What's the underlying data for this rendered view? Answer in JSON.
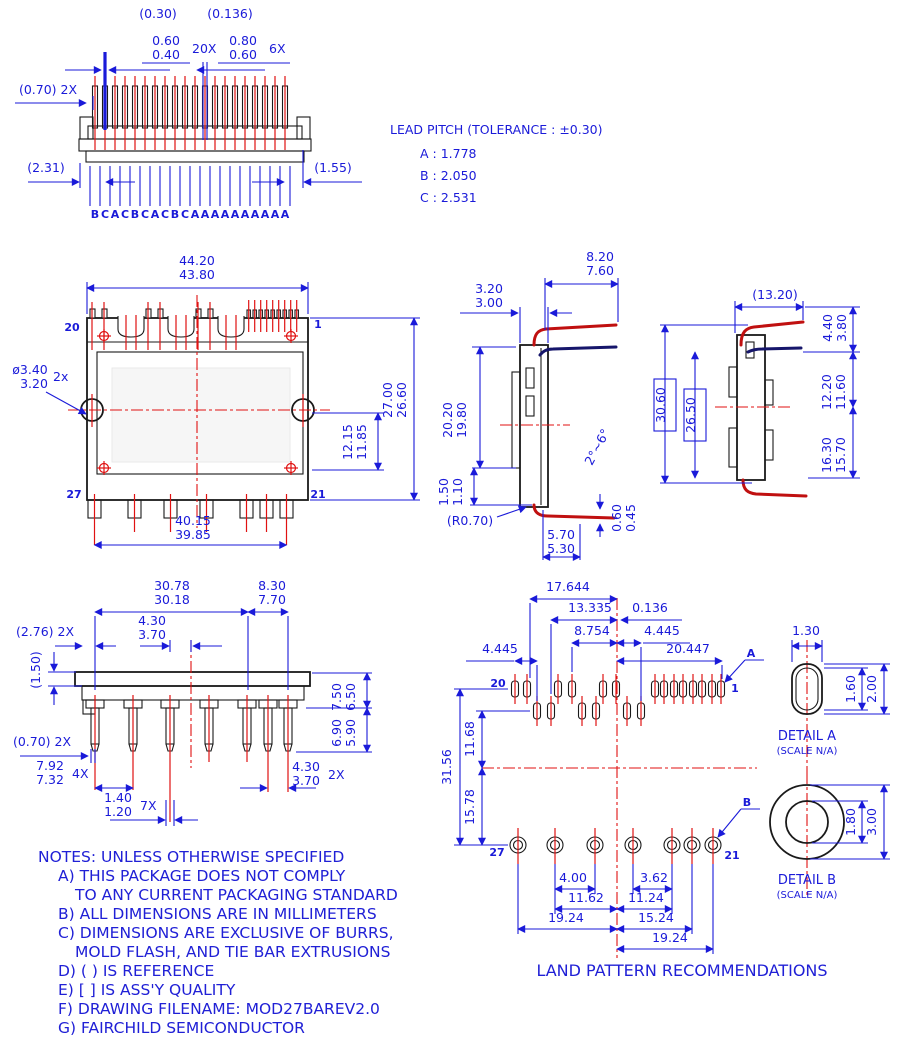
{
  "colors": {
    "dimension_blue": "#1a1ad9",
    "lead_red": "#c01010",
    "lead_dark_blue": "#16166b",
    "outline_black": "#1a1a1a",
    "background": "#ffffff"
  },
  "top_view": {
    "ref_030": "(0.30)",
    "ref_0136": "(0.136)",
    "w1_max": "0.60",
    "w1_min": "0.40",
    "w1_qty": "20X",
    "w2_max": "0.80",
    "w2_min": "0.60",
    "w2_qty": "6X",
    "ref_070": "(0.70) 2X",
    "ref_231": "(2.31)",
    "ref_155": "(1.55)",
    "letters": [
      "B",
      "C",
      "A",
      "C",
      "B",
      "C",
      "A",
      "C",
      "B",
      "C",
      "A",
      "A",
      "A",
      "A",
      "A",
      "A",
      "A",
      "A",
      "A",
      "A"
    ]
  },
  "lead_pitch_note": {
    "title": "LEAD PITCH (TOLERANCE : ±0.30)",
    "items": [
      "A : 1.778",
      "B : 2.050",
      "C : 2.531"
    ]
  },
  "front_view": {
    "width_max": "44.20",
    "width_min": "43.80",
    "pin_top_left": "20",
    "pin_top_right": "1",
    "pin_bottom_left": "27",
    "pin_bottom_right": "21",
    "hole_max": "ø3.40",
    "hole_min": "3.20",
    "hole_qty": "2x",
    "height_max": "27.00",
    "height_min": "26.60",
    "mid_max": "12.15",
    "mid_min": "11.85",
    "bottom_max": "40.15",
    "bottom_min": "39.85"
  },
  "side_view": {
    "lead_max": "8.20",
    "lead_min": "7.60",
    "top_max": "3.20",
    "top_min": "3.00",
    "body_max": "20.20",
    "body_min": "19.80",
    "stand_max": "1.50",
    "stand_min": "1.10",
    "radius_ref": "(R0.70)",
    "foot_max": "5.70",
    "foot_min": "5.30",
    "thk_max": "0.60",
    "thk_min": "0.45",
    "angle": "2°~6°"
  },
  "end_view": {
    "ref_width": "(13.20)",
    "top_max": "4.40",
    "top_min": "3.80",
    "upper_max": "12.20",
    "upper_min": "11.60",
    "lower_max": "16.30",
    "lower_min": "15.70",
    "overall": "30.60",
    "inner": "26.50"
  },
  "bottom_view": {
    "span_max": "30.78",
    "span_min": "30.18",
    "right_max": "8.30",
    "right_min": "7.70",
    "center_max": "4.30",
    "center_min": "3.70",
    "ref_276": "(2.76) 2X",
    "ref_150": "(1.50)",
    "ref_070": "(0.70) 2X",
    "len_max": "7.92",
    "len_min": "7.32",
    "len_qty": "4X",
    "tip_max": "1.40",
    "tip_min": "1.20",
    "tip_qty": "7X",
    "h1_max": "7.50",
    "h1_min": "6.50",
    "h2_max": "6.90",
    "h2_min": "5.90",
    "pitch_max": "4.30",
    "pitch_min": "3.70",
    "pitch_qty": "2X"
  },
  "land_pattern": {
    "title": "LAND PATTERN RECOMMENDATIONS",
    "d_17644": "17.644",
    "d_13335": "13.335",
    "d_0136": "0.136",
    "d_8754": "8.754",
    "d_4445_r": "4.445",
    "d_4445_l": "4.445",
    "d_20447": "20.447",
    "v_3156": "31.56",
    "v_1168": "11.68",
    "v_1578": "15.78",
    "b_400": "4.00",
    "b_362": "3.62",
    "b_1162": "11.62",
    "b_1124": "11.24",
    "b_1924_l": "19.24",
    "b_1524": "15.24",
    "b_1924_r": "19.24",
    "pin_top_left": "20",
    "pin_top_right": "1",
    "pin_bottom_left": "27",
    "pin_bottom_right": "21",
    "leader_a": "A",
    "leader_b": "B"
  },
  "detail_a": {
    "label": "DETAIL A",
    "scale": "(SCALE N/A)",
    "width": "1.30",
    "inner_height": "1.60",
    "outer_height": "2.00"
  },
  "detail_b": {
    "label": "DETAIL B",
    "scale": "(SCALE N/A)",
    "inner_dia": "1.80",
    "outer_dia": "3.00"
  },
  "notes": {
    "lines": [
      "NOTES: UNLESS OTHERWISE SPECIFIED",
      "A) THIS PACKAGE DOES NOT COMPLY",
      "TO ANY CURRENT PACKAGING STANDARD",
      "B) ALL DIMENSIONS ARE IN MILLIMETERS",
      "C) DIMENSIONS ARE EXCLUSIVE OF BURRS,",
      "MOLD FLASH, AND TIE BAR EXTRUSIONS",
      "D) ( ) IS REFERENCE",
      "E) [ ] IS ASS'Y QUALITY",
      "F) DRAWING FILENAME: MOD27BAREV2.0",
      "G) FAIRCHILD SEMICONDUCTOR"
    ]
  }
}
